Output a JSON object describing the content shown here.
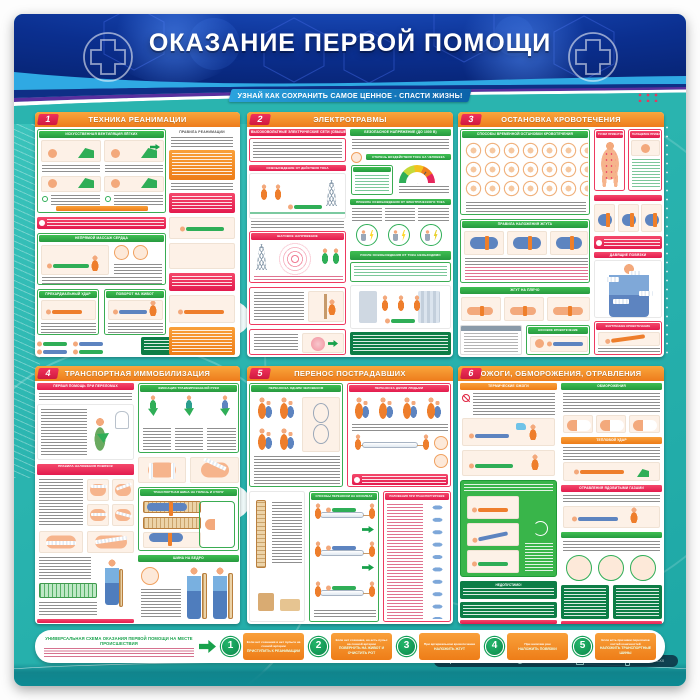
{
  "poster": {
    "title": "ОКАЗАНИЕ ПЕРВОЙ ПОМОЩИ",
    "subtitle": "УЗНАЙ КАК СОХРАНИТЬ САМОЕ ЦЕННОЕ - СПАСТИ ЖИЗНЬ!"
  },
  "panels": [
    {
      "number": "1",
      "title": "ТЕХНИКА РЕАНИМАЦИИ",
      "sections": {
        "ventilation": "ИСКУССТВЕННАЯ ВЕНТИЛЯЦИЯ ЛЁГКИХ",
        "rules": "ПРАВИЛА РЕАНИМАЦИИ",
        "massage": "НЕПРЯМОЙ МАССАЖ СЕРДЦА",
        "precordial": "ПРЕКАРДИАЛЬНЫЙ УДАР",
        "turn": "ПОВОРОТ НА ЖИВОТ"
      }
    },
    {
      "number": "2",
      "title": "ЭЛЕКТРОТРАВМЫ",
      "sections": {
        "high_voltage": "ВЫСОКОВОЛЬТНЫЕ ЭЛЕКТРИЧЕСКИЕ СЕТИ (СВЫШЕ 1000 В)",
        "release": "ОСВОБОЖДЕНИЕ ОТ ДЕЙСТВИЯ ТОКА",
        "step_voltage": "ШАГОВОЕ НАПРЯЖЕНИЕ",
        "safe_voltage": "БЕЗОПАСНОЕ НАПРЯЖЕНИЕ (ДО 1000 В)",
        "impact": "СТЕПЕНЬ ВОЗДЕЙСТВИЯ ТОКА НА ЧЕЛОВЕКА",
        "rules": "ПРАВИЛА ОСВОБОЖДЕНИЯ ОТ ЭЛЕКТРИЧЕСКОГО ТОКА",
        "after": "ПОСЛЕ ОСВОБОЖДЕНИЯ ОТ ТОКА НЕОБХОДИМО"
      }
    },
    {
      "number": "3",
      "title": "ОСТАНОВКА КРОВОТЕЧЕНИЯ",
      "sections": {
        "temporary": "СПОСОБЫ ВРЕМЕННОЙ ОСТАНОВКИ КРОВОТЕЧЕНИЯ",
        "tourniquet": "ПРАВИЛА НАЛОЖЕНИЯ ЖГУТА",
        "arm": "ЖГУТ НА ПЛЕЧО",
        "points": "ТОЧКИ ПРИЖАТИЯ АРТЕРИЙ",
        "finger": "ПАЛЬЦЕВОЕ ПРИЖАТИЕ АРТЕРИЙ",
        "pressure": "ДАВЯЩИЕ ПОВЯЗКИ",
        "nose": "НОСОВОЕ КРОВОТЕЧЕНИЕ",
        "internal": "ВНУТРЕННЕЕ КРОВОТЕЧЕНИЕ"
      }
    },
    {
      "number": "4",
      "title": "ТРАНСПОРТНАЯ ИММОБИЛИЗАЦИЯ",
      "sections": {
        "fractures": "ПЕРВАЯ ПОМОЩЬ ПРИ ПЕРЕЛОМАХ",
        "bandage": "ПРАВИЛА НАЛОЖЕНИЯ ПОВЯЗОК",
        "arm_fix": "ФИКСАЦИЯ ТРАВМИРОВАННОЙ РУКИ",
        "leg_splint": "ТРАНСПОРТНАЯ ШИНА НА ГОЛЕНЬ И СТОПУ",
        "hip_splint": "ШИНА НА БЕДРО"
      }
    },
    {
      "number": "5",
      "title": "ПЕРЕНОС ПОСТРАДАВШИХ",
      "sections": {
        "one_person": "ПЕРЕНОСКА ОДНИМ ЧЕЛОВЕКОМ",
        "two_person": "ПЕРЕНОСКА ДВУМЯ ЛЮДЬМИ",
        "stretcher": "СПОСОБЫ ПЕРЕНОСКИ НА НОСИЛКАХ",
        "transport_positions": "ПОЛОЖЕНИЯ ПРИ ТРАНСПОРТИРОВКЕ"
      }
    },
    {
      "number": "6",
      "title": "ОЖОГИ, ОБМОРОЖЕНИЯ, ОТРАВЛЕНИЯ",
      "sections": {
        "burns": "ТЕРМИЧЕСКИЕ ОЖОГИ",
        "frostbite": "ОБМОРОЖЕНИЯ",
        "heat": "ТЕПЛОВОЙ УДАР",
        "poisoning": "ОТРАВЛЕНИЯ ЯДОВИТЫМИ ГАЗАМИ",
        "forbidden": "НЕДОПУСТИМО!"
      }
    }
  ],
  "scheme": {
    "title": "УНИВЕРСАЛЬНАЯ СХЕМА ОКАЗАНИЯ ПЕРВОЙ ПОМОЩИ НА МЕСТЕ ПРОИСШЕСТВИЯ",
    "steps": [
      {
        "number": "1",
        "condition": "Если нет сознания и нет пульса на сонной артерии",
        "action": "ПРИСТУПИТЬ К РЕАНИМАЦИИ"
      },
      {
        "number": "2",
        "condition": "Если нет сознания, но есть пульс на сонной артерии",
        "action": "ПОВЕРНУТЬ НА ЖИВОТ И ОЧИСТИТЬ РОТ"
      },
      {
        "number": "3",
        "condition": "При артериальном кровотечении",
        "action": "НАЛОЖИТЬ ЖГУТ"
      },
      {
        "number": "4",
        "condition": "При наличии ран",
        "action": "НАЛОЖИТЬ ПОВЯЗКИ"
      },
      {
        "number": "5",
        "condition": "Если есть признаки переломов костей конечностей",
        "action": "НАЛОЖИТЬ ТРАНСПОРТНЫЕ ШИНЫ"
      }
    ]
  },
  "footer": {
    "org": "Наименование организации",
    "address": "Ваш город, улица, дом",
    "email": "mypost@mail.ru",
    "phone": "+7 (XXX) XX-XX-XX"
  },
  "colors": {
    "accent_orange": "#ee7c1c",
    "accent_green": "#2fae57",
    "accent_red": "#e31b4e",
    "teal_background": "#2ab4af",
    "header_navy": "#0b2f8f"
  }
}
